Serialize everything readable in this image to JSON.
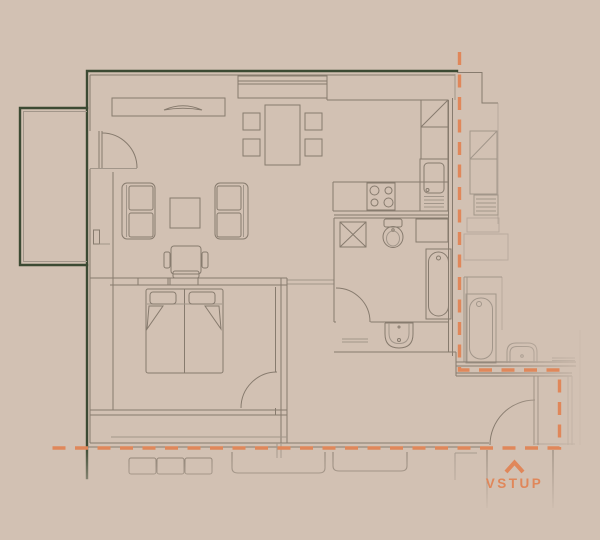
{
  "entrance": {
    "label": "VSTUP",
    "icon": "chevron-up-icon"
  },
  "theme": {
    "background": "#d2c1b3",
    "plan_line": "#877b6e",
    "plan_line_faint": "#a2968a",
    "wall_green": "#3c4a33",
    "accent_orange": "#e0875a"
  }
}
